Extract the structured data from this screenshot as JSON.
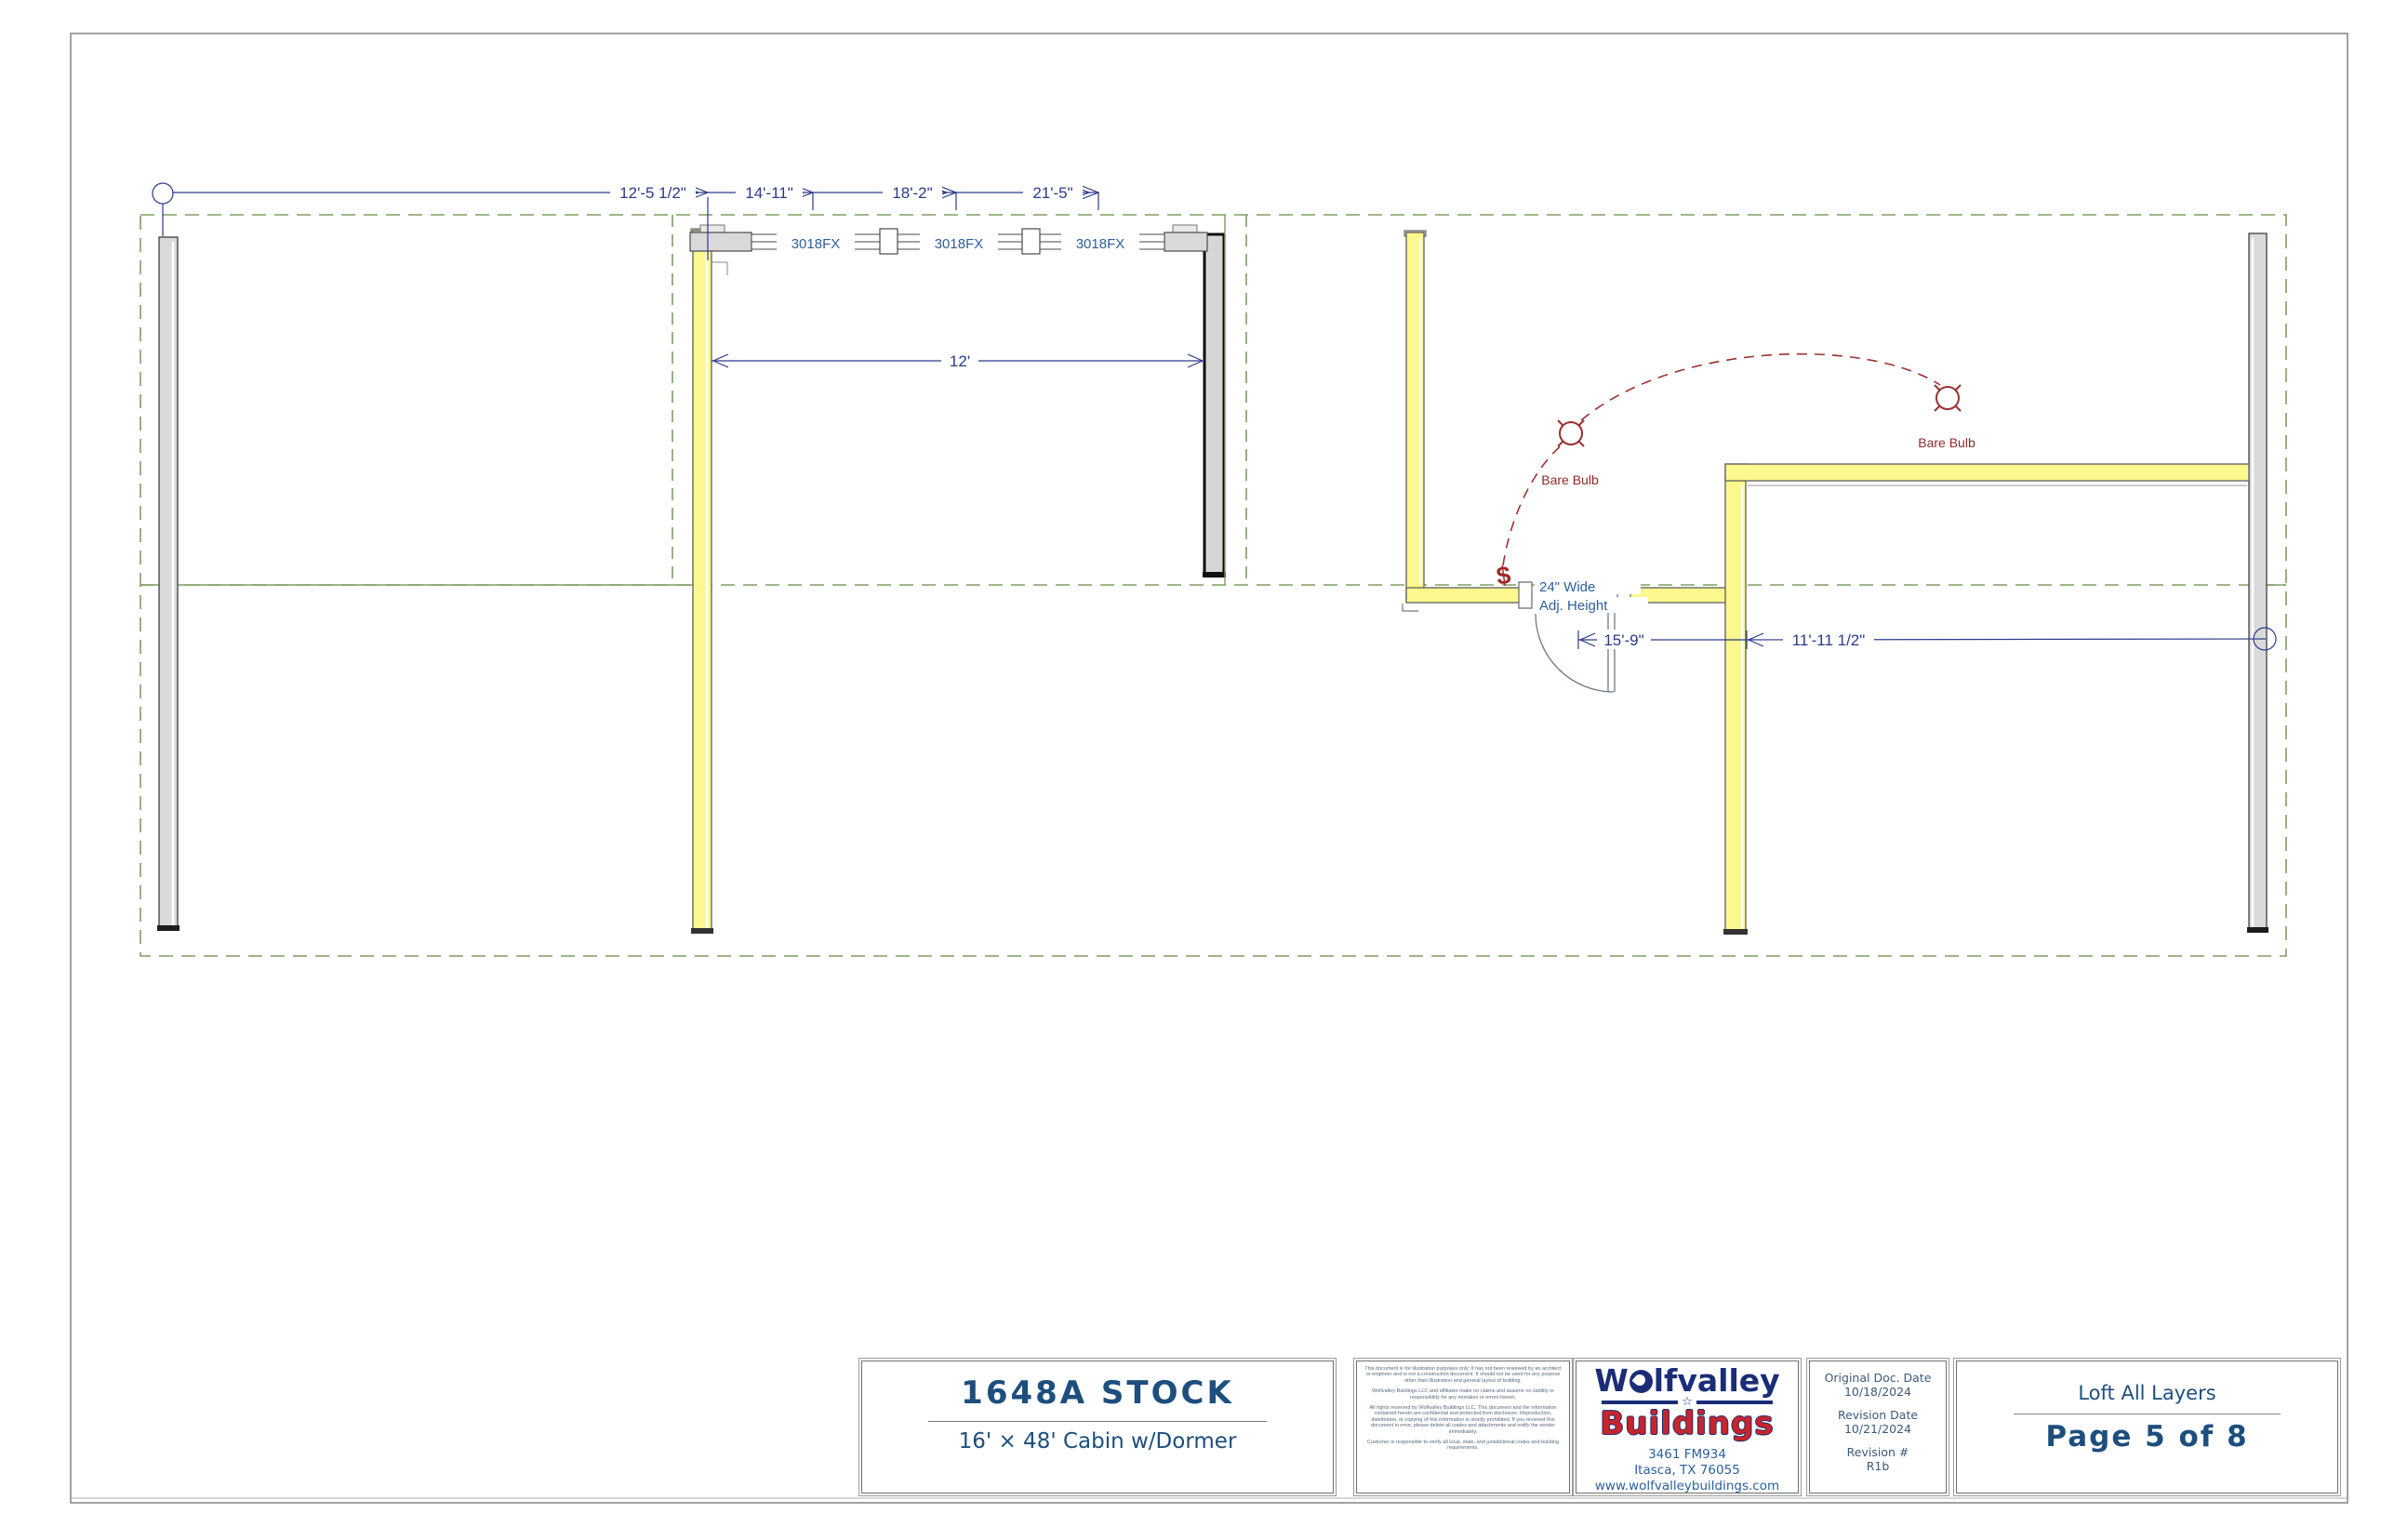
{
  "plan": {
    "dim_top": [
      "12'-5 1/2\"",
      "14'-11\"",
      "18'-2\"",
      "21'-5\""
    ],
    "dim_dormer_width": "12'",
    "dim_room_left": "15'-9\"",
    "dim_room_right": "11'-11 1/2\"",
    "window_label": "3018FX",
    "bulb_label": "Bare Bulb",
    "switch_symbol": "$",
    "door_note_line1": "24\" Wide",
    "door_note_line2": "Adj. Height"
  },
  "title_block": {
    "model": "1648A STOCK",
    "description": "16' × 48' Cabin w/Dormer",
    "disclaimer": {
      "p1": "This document is for illustration purposes only; it has not been reviewed by an architect or engineer and is not a construction document. It should not be used for any purpose other than illustration and general layout of building.",
      "p2": "Wolfvalley Buildings LLC and affiliates make no claims and assume no liability or responsibility for any mistakes or errors herein.",
      "p3": "All rights reserved by Wolfvalley Buildings LLC. This document and the information contained herein are confidential and protected from disclosure. Reproduction, distribution, or copying of this information is strictly prohibited. If you received this document in error, please delete all copies and attachments and notify the sender immediately.",
      "p4": "Customer is responsible to verify all local, state, and jurisdictional codes and building requirements."
    },
    "logo": {
      "brand_w": "W",
      "brand_rest": "lfvalley",
      "brand_line2": "Buildings",
      "star": "☆",
      "address_line1": "3461 FM934",
      "address_line2": "Itasca, TX 76055",
      "website": "www.wolfvalleybuildings.com"
    },
    "revisions": {
      "original_label": "Original Doc. Date",
      "original_date": "10/18/2024",
      "revision_date_label": "Revision Date",
      "revision_date": "10/21/2024",
      "revision_no_label": "Revision #",
      "revision_no": "R1b"
    },
    "footer": {
      "layer_name": "Loft All Layers",
      "page_label": "Page 5 of 8"
    }
  },
  "colors": {
    "annotation_blue": "#2b3a8c",
    "cad_text_blue": "#2d5f9e",
    "title_navy": "#1d4e7e",
    "electrical_red": "#9e2f2a",
    "layer_green": "#7e9d64",
    "wall_yellow": "#fbf88e",
    "wall_gray": "#dadada",
    "logo_navy": "#1b2d78",
    "logo_red": "#c8242c"
  }
}
